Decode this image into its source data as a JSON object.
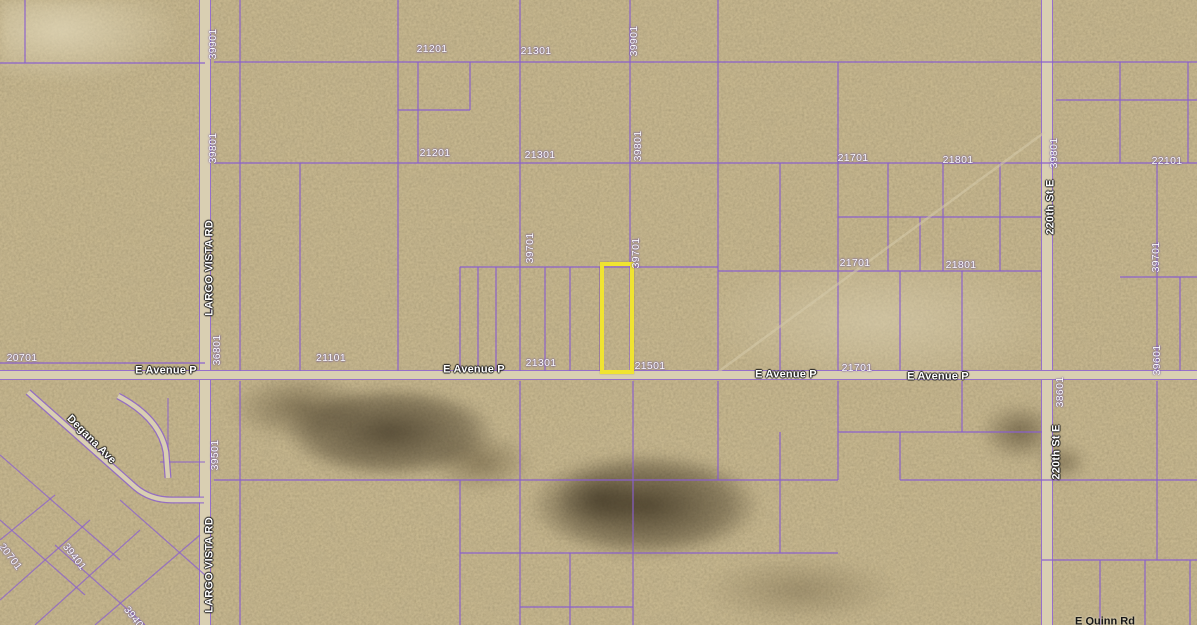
{
  "map": {
    "title": "Aerial parcel map - E Avenue P at Largo Vista Rd",
    "colors": {
      "desert_base": "#c7b78e",
      "parcel_line": "#8a5ecf",
      "road_fill": "#d9cfb2",
      "highlight_yellow": "#f0e431",
      "label_white": "#fdfdfd"
    },
    "highlighted_parcel": {
      "x": 600,
      "y": 262,
      "w": 34,
      "h": 112,
      "note_label_adjacent": "21501"
    },
    "roads": {
      "largo_vista": {
        "name": "LARGO VISTA RD",
        "x": 199
      },
      "street_220th": {
        "name": "220th St E",
        "x": 1041
      },
      "avenue_p": {
        "name": "E Avenue P",
        "y": 370
      }
    },
    "labels": [
      {
        "text": "21201",
        "x": 432,
        "y": 49,
        "rot": 0,
        "kind": "pnum"
      },
      {
        "text": "21301",
        "x": 536,
        "y": 51,
        "rot": 0,
        "kind": "pnum"
      },
      {
        "text": "21201",
        "x": 435,
        "y": 153,
        "rot": 0,
        "kind": "pnum"
      },
      {
        "text": "21301",
        "x": 540,
        "y": 155,
        "rot": 0,
        "kind": "pnum"
      },
      {
        "text": "21701",
        "x": 853,
        "y": 158,
        "rot": 0,
        "kind": "pnum"
      },
      {
        "text": "21801",
        "x": 958,
        "y": 160,
        "rot": 0,
        "kind": "pnum"
      },
      {
        "text": "22101",
        "x": 1167,
        "y": 161,
        "rot": 0,
        "kind": "pnum"
      },
      {
        "text": "21701",
        "x": 855,
        "y": 263,
        "rot": 0,
        "kind": "pnum"
      },
      {
        "text": "21801",
        "x": 961,
        "y": 265,
        "rot": 0,
        "kind": "pnum"
      },
      {
        "text": "20701",
        "x": 22,
        "y": 358,
        "rot": 0,
        "kind": "pnum"
      },
      {
        "text": "21101",
        "x": 331,
        "y": 358,
        "rot": 0,
        "kind": "pnum"
      },
      {
        "text": "21301",
        "x": 541,
        "y": 363,
        "rot": 0,
        "kind": "pnum"
      },
      {
        "text": "21501",
        "x": 650,
        "y": 366,
        "rot": 0,
        "kind": "pnum"
      },
      {
        "text": "21701",
        "x": 857,
        "y": 368,
        "rot": 0,
        "kind": "pnum"
      },
      {
        "text": "39901",
        "x": 213,
        "y": 44,
        "rot": -90,
        "kind": "pnum"
      },
      {
        "text": "39801",
        "x": 213,
        "y": 148,
        "rot": -90,
        "kind": "pnum"
      },
      {
        "text": "39901",
        "x": 634,
        "y": 41,
        "rot": -90,
        "kind": "pnum"
      },
      {
        "text": "39801",
        "x": 638,
        "y": 146,
        "rot": -90,
        "kind": "pnum"
      },
      {
        "text": "39701",
        "x": 530,
        "y": 248,
        "rot": -90,
        "kind": "pnum"
      },
      {
        "text": "39701",
        "x": 636,
        "y": 253,
        "rot": -90,
        "kind": "pnum"
      },
      {
        "text": "36801",
        "x": 217,
        "y": 350,
        "rot": -90,
        "kind": "pnum"
      },
      {
        "text": "39501",
        "x": 215,
        "y": 455,
        "rot": -90,
        "kind": "pnum"
      },
      {
        "text": "39801",
        "x": 1054,
        "y": 153,
        "rot": -90,
        "kind": "pnum"
      },
      {
        "text": "38601",
        "x": 1060,
        "y": 392,
        "rot": -90,
        "kind": "pnum"
      },
      {
        "text": "39701",
        "x": 1156,
        "y": 257,
        "rot": -90,
        "kind": "pnum"
      },
      {
        "text": "39601",
        "x": 1157,
        "y": 360,
        "rot": -90,
        "kind": "pnum"
      },
      {
        "text": "20701",
        "x": 10,
        "y": 557,
        "rot": 52,
        "kind": "pnum"
      },
      {
        "text": "39401",
        "x": 74,
        "y": 557,
        "rot": 52,
        "kind": "pnum"
      },
      {
        "text": "39401",
        "x": 135,
        "y": 620,
        "rot": 52,
        "kind": "pnum"
      },
      {
        "text": "E Avenue P",
        "x": 166,
        "y": 371,
        "rot": 0,
        "kind": "road"
      },
      {
        "text": "E Avenue P",
        "x": 474,
        "y": 370,
        "rot": 0,
        "kind": "road"
      },
      {
        "text": "E Avenue P",
        "x": 786,
        "y": 375,
        "rot": 0,
        "kind": "road"
      },
      {
        "text": "E Avenue P",
        "x": 938,
        "y": 377,
        "rot": 0,
        "kind": "road"
      },
      {
        "text": "LARGO VISTA RD",
        "x": 210,
        "y": 268,
        "rot": -90,
        "kind": "road"
      },
      {
        "text": "LARGO VISTA RD",
        "x": 210,
        "y": 565,
        "rot": -90,
        "kind": "road"
      },
      {
        "text": "220th St E",
        "x": 1051,
        "y": 207,
        "rot": -90,
        "kind": "road"
      },
      {
        "text": "220th St E",
        "x": 1057,
        "y": 452,
        "rot": -90,
        "kind": "road"
      },
      {
        "text": "Degana Ave",
        "x": 91,
        "y": 440,
        "rot": 45,
        "kind": "road"
      },
      {
        "text": "E Quinn Rd",
        "x": 1105,
        "y": 622,
        "rot": 0,
        "kind": "dark"
      }
    ],
    "parcel_lines": [
      [
        0,
        63,
        205,
        63
      ],
      [
        214,
        62,
        1197,
        62
      ],
      [
        214,
        163,
        1197,
        163
      ],
      [
        460,
        267,
        718,
        267
      ],
      [
        718,
        271,
        1042,
        271
      ],
      [
        1120,
        277,
        1197,
        277
      ],
      [
        838,
        217,
        1042,
        217
      ],
      [
        398,
        110,
        470,
        110
      ],
      [
        0,
        363,
        205,
        363
      ],
      [
        1056,
        100,
        1197,
        100
      ],
      [
        214,
        480,
        838,
        480
      ],
      [
        460,
        553,
        838,
        553
      ],
      [
        838,
        432,
        1042,
        432
      ],
      [
        900,
        480,
        1197,
        480
      ],
      [
        1042,
        560,
        1197,
        560
      ],
      [
        520,
        607,
        633,
        607
      ],
      [
        25,
        0,
        25,
        63
      ],
      [
        240,
        0,
        240,
        371
      ],
      [
        240,
        381,
        240,
        625
      ],
      [
        300,
        163,
        300,
        371
      ],
      [
        398,
        0,
        398,
        371
      ],
      [
        418,
        62,
        418,
        163
      ],
      [
        470,
        62,
        470,
        110
      ],
      [
        460,
        267,
        460,
        371
      ],
      [
        460,
        480,
        460,
        625
      ],
      [
        478,
        267,
        478,
        371
      ],
      [
        496,
        267,
        496,
        371
      ],
      [
        520,
        0,
        520,
        371
      ],
      [
        520,
        381,
        520,
        625
      ],
      [
        545,
        267,
        545,
        371
      ],
      [
        570,
        267,
        570,
        371
      ],
      [
        570,
        553,
        570,
        625
      ],
      [
        600,
        267,
        600,
        371
      ],
      [
        630,
        0,
        630,
        371
      ],
      [
        633,
        381,
        633,
        625
      ],
      [
        718,
        0,
        718,
        371
      ],
      [
        718,
        381,
        718,
        480
      ],
      [
        780,
        163,
        780,
        371
      ],
      [
        780,
        432,
        780,
        553
      ],
      [
        838,
        62,
        838,
        371
      ],
      [
        838,
        381,
        838,
        480
      ],
      [
        888,
        163,
        888,
        271
      ],
      [
        920,
        217,
        920,
        271
      ],
      [
        943,
        163,
        943,
        271
      ],
      [
        1000,
        163,
        1000,
        271
      ],
      [
        900,
        271,
        900,
        371
      ],
      [
        900,
        432,
        900,
        480
      ],
      [
        962,
        271,
        962,
        371
      ],
      [
        962,
        381,
        962,
        432
      ],
      [
        1120,
        62,
        1120,
        163
      ],
      [
        1188,
        62,
        1188,
        163
      ],
      [
        1157,
        163,
        1157,
        371
      ],
      [
        1157,
        381,
        1157,
        560
      ],
      [
        1180,
        277,
        1180,
        371
      ],
      [
        1100,
        560,
        1100,
        625
      ],
      [
        1145,
        560,
        1145,
        625
      ],
      [
        1190,
        560,
        1190,
        625
      ]
    ],
    "subdivision_lot_lines": [
      [
        0,
        455,
        120,
        560
      ],
      [
        0,
        520,
        85,
        595
      ],
      [
        55,
        545,
        145,
        625
      ],
      [
        120,
        500,
        205,
        575
      ],
      [
        0,
        600,
        90,
        520
      ],
      [
        35,
        625,
        140,
        530
      ],
      [
        95,
        625,
        200,
        535
      ],
      [
        0,
        540,
        55,
        495
      ],
      [
        168,
        398,
        168,
        462
      ],
      [
        160,
        462,
        205,
        462
      ]
    ],
    "subdivision_streets": [
      {
        "d": "M 28,392 L 135,487 Q 150,500 172,500 L 204,500"
      },
      {
        "d": "M 118,396 Q 160,418 166,452 L 168,478"
      }
    ],
    "trails": [
      [
        718,
        372,
        1045,
        132
      ]
    ]
  }
}
